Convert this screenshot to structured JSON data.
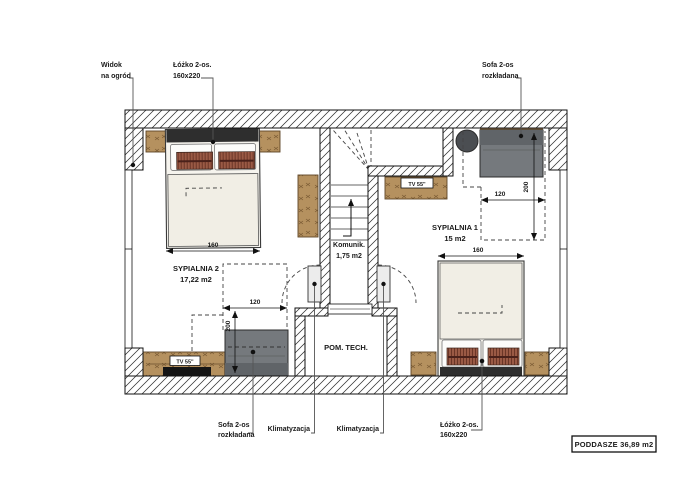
{
  "plan": {
    "title": "PODDASZE 36,89 m2",
    "rooms": {
      "bedroom2": {
        "name": "SYPIALNIA 2",
        "area": "17,22 m2"
      },
      "bedroom1": {
        "name": "SYPIALNIA 1",
        "area": "15 m2"
      },
      "corridor": {
        "name": "Komunik.",
        "area": "1,75 m2"
      },
      "technical": {
        "name": "POM. TECH."
      }
    },
    "callouts": {
      "view": {
        "line1": "Widok",
        "line2": "na ogród"
      },
      "bed_top": {
        "line1": "Łóżko 2-os.",
        "line2": "160x220"
      },
      "sofa_top": {
        "line1": "Sofa 2-os",
        "line2": "rozkładana"
      },
      "sofa_bottom": {
        "line1": "Sofa 2-os",
        "line2": "rozkładana"
      },
      "ac_left": {
        "label": "Klimatyzacja"
      },
      "ac_right": {
        "label": "Klimatyzacja"
      },
      "bed_bottom": {
        "line1": "Łóżko 2-os.",
        "line2": "160x220"
      }
    },
    "furniture": {
      "tv_bedroom1": "TV 55\"",
      "tv_bedroom2": "TV 55\""
    },
    "dimensions": {
      "bed2_width": "160",
      "sofa2_width": "120",
      "sofa2_depth": "200",
      "sofa1_width": "120",
      "sofa1_depth": "200",
      "bed1_width": "160"
    },
    "colors": {
      "wood": "#b5915f",
      "sofa_gray": "#75797d",
      "accent_pillow": "#9a5a45",
      "headboard": "#2e2e2e"
    }
  }
}
